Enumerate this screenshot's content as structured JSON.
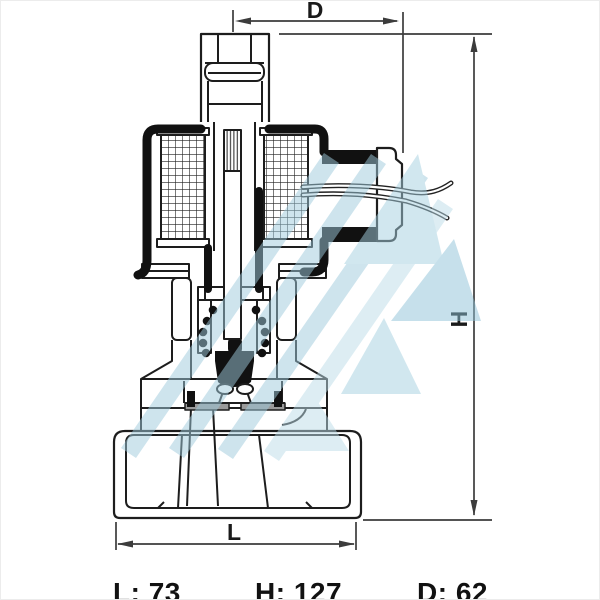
{
  "diagram": {
    "type": "solenoid-valve-cross-section",
    "dimensions": {
      "top": {
        "label": "D"
      },
      "right": {
        "label": "H"
      },
      "bottom": {
        "label": "L"
      }
    },
    "specs": {
      "length": {
        "label": "L",
        "value": "73",
        "display": "L: 73"
      },
      "height": {
        "label": "H",
        "value": "127",
        "display": "H: 127"
      },
      "diameter": {
        "label": "D",
        "value": "62",
        "display": "D: 62"
      }
    },
    "colors": {
      "line": "#1d1d1d",
      "solid_fill": "#111111",
      "dimension_line": "#3c3c3c",
      "seat_gray": "#9a9a9a",
      "watermark_light": "#bcdde9",
      "watermark_mid": "#9fcbdd",
      "watermark_dark": "#8fc3d8",
      "background": "#ffffff"
    }
  }
}
